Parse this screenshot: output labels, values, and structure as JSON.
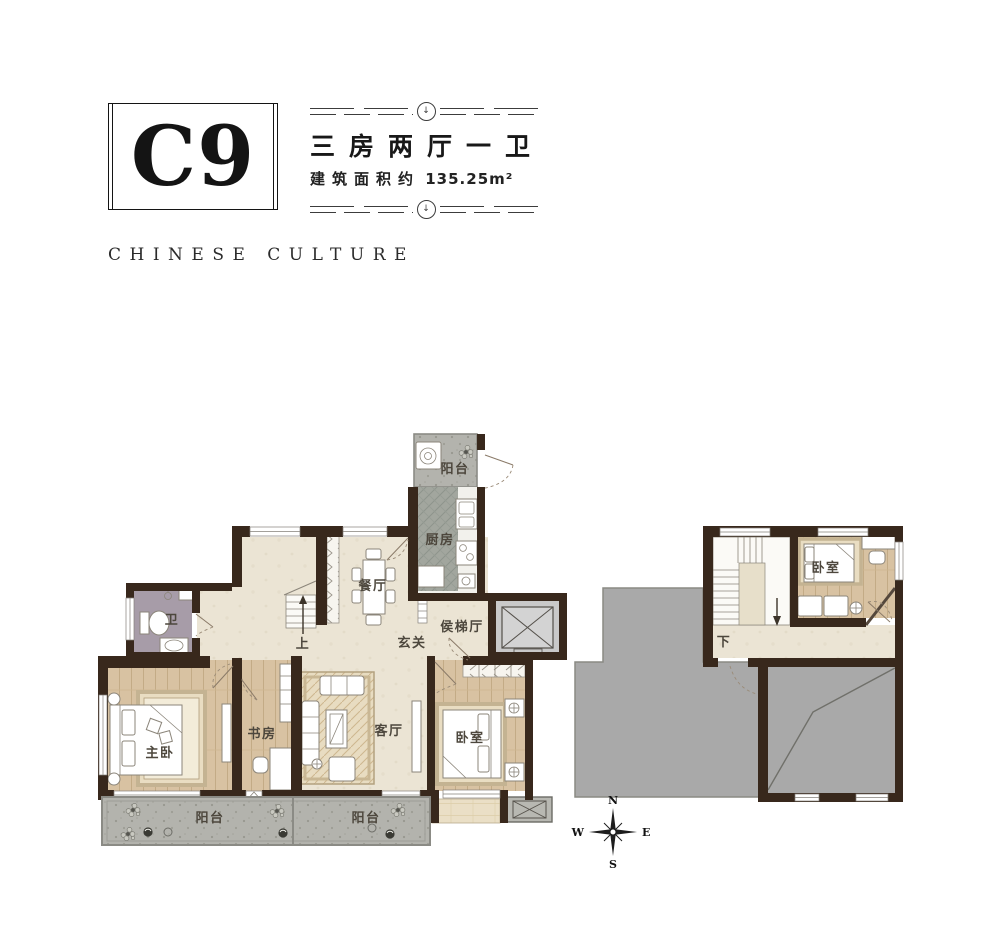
{
  "header": {
    "unit_code": "C9",
    "layout_title": "三房两厅一卫",
    "area_prefix": "建筑面积约",
    "area_value": "135.25m²",
    "subtitle": "CHINESE CULTURE",
    "ornament_glyph": "↓"
  },
  "rooms": {
    "balcony_north": "阳台",
    "kitchen": "厨房",
    "dining": "餐厅",
    "bathroom": "卫",
    "stairs_up": "上",
    "foyer": "玄关",
    "elevator_hall": "侯梯厅",
    "master_bedroom": "主卧",
    "study": "书房",
    "living_room": "客厅",
    "bedroom": "卧室",
    "balcony_sw": "阳台",
    "balcony_se": "阳台",
    "loft_bedroom": "卧室",
    "stairs_down": "下"
  },
  "compass": {
    "north": "N",
    "south": "S",
    "east": "E",
    "west": "W"
  },
  "palette": {
    "wall": "#38281c",
    "cream_floor": "#ebe4d4",
    "wood_floor": "#d8c2a2",
    "balcony_gray": "#b3b3ad",
    "kitchen_gray": "#a2a69e",
    "bath_floor": "#a79ca8",
    "terrace_gray": "#a9a9a9",
    "marble": "#eadfc6",
    "elevator_gray": "#c9c9c9"
  }
}
